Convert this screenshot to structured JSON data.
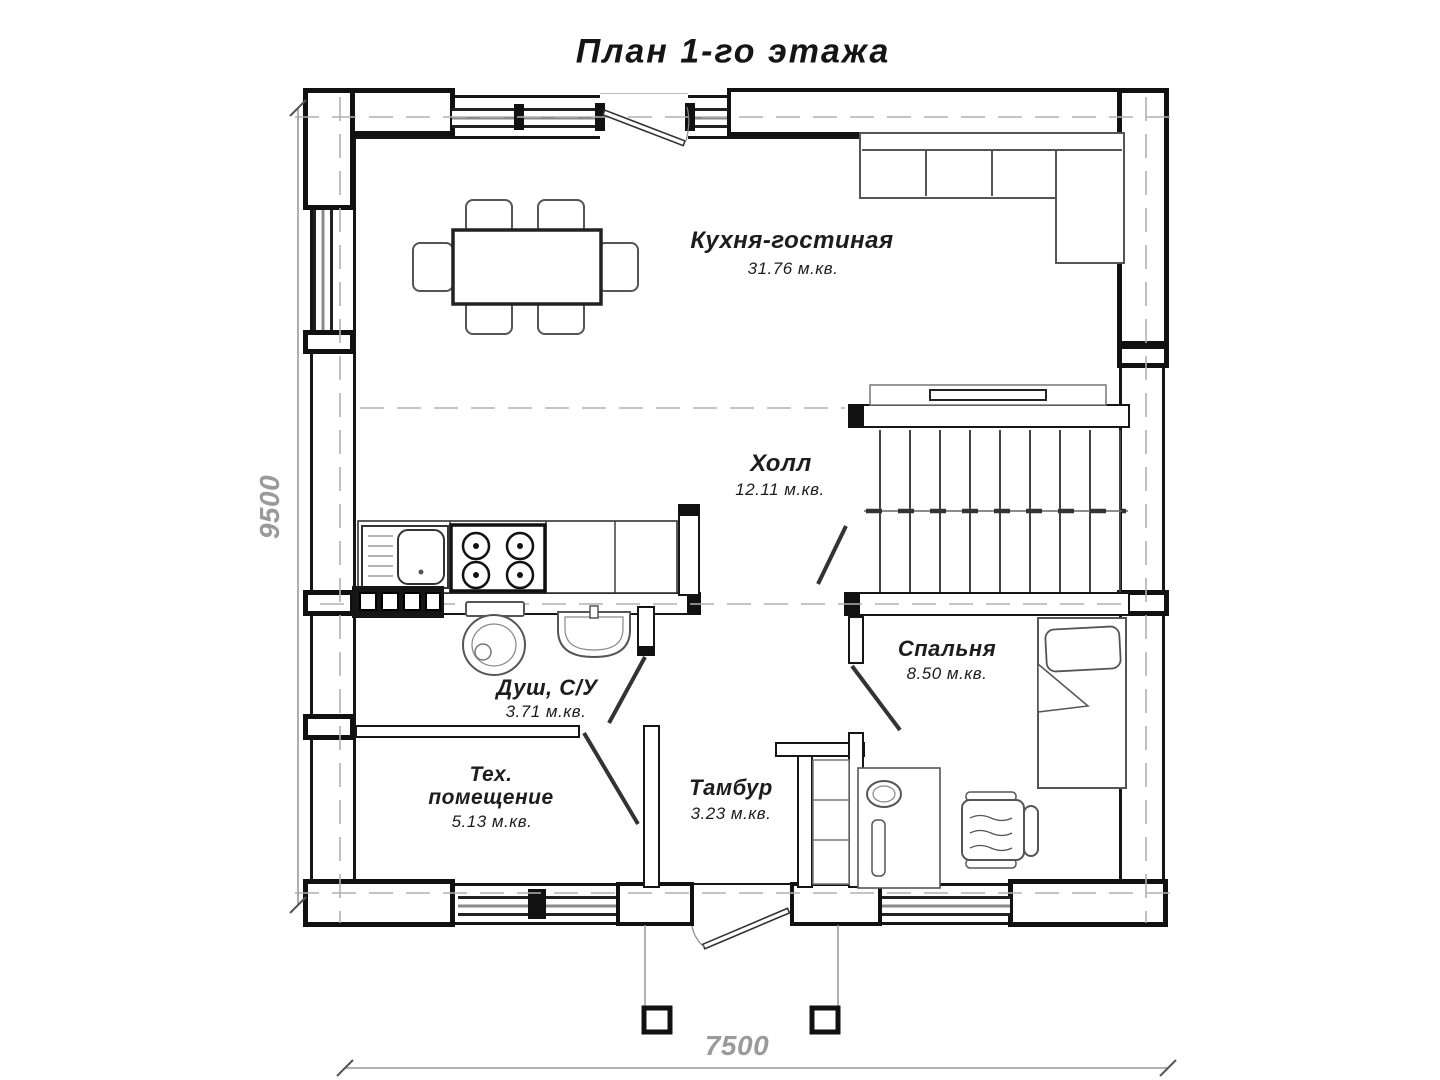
{
  "title": "План 1-го этажа",
  "colors": {
    "line": "#1a1a1a",
    "dimension_gray": "#9a9a9a",
    "furniture_gray": "#555555"
  },
  "rooms": [
    {
      "id": "kitchen-living",
      "name": "Кухня-гостиная",
      "area": "31.76 м.кв."
    },
    {
      "id": "hall",
      "name": "Холл",
      "area": "12.11 м.кв."
    },
    {
      "id": "shower-wc",
      "name": "Душ, С/У",
      "area": "3.71 м.кв."
    },
    {
      "id": "tech-room",
      "name": "Тех. помещение",
      "area": "5.13 м.кв."
    },
    {
      "id": "vestibule",
      "name": "Тамбур",
      "area": "3.23 м.кв."
    },
    {
      "id": "bedroom",
      "name": "Спальня",
      "area": "8.50 м.кв."
    }
  ],
  "dimensions": {
    "bottom_width_mm": "7500",
    "left_height_mm": "9500"
  }
}
